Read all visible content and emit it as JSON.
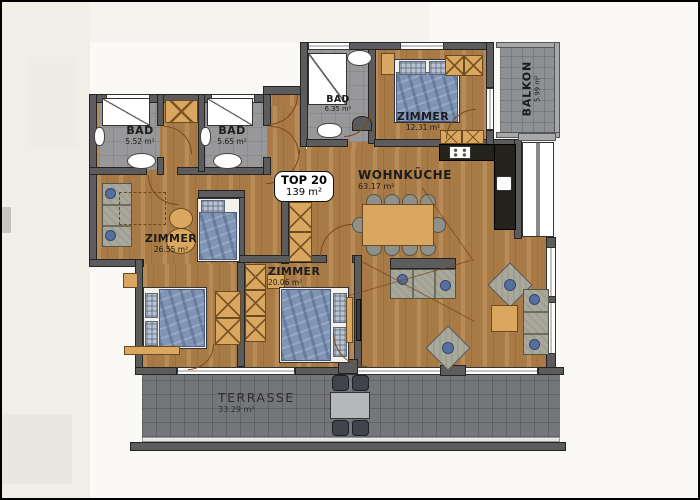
{
  "unit": {
    "name": "TOP 20",
    "area": "139 m²"
  },
  "rooms": {
    "bad1": {
      "name": "BAD",
      "area": "5.52 m²"
    },
    "bad2": {
      "name": "BAD",
      "area": "5.65 m²"
    },
    "bad3": {
      "name": "BAD",
      "area": "6.35 m²"
    },
    "zimmer1": {
      "name": "ZIMMER",
      "area": "12.31 m²"
    },
    "zimmer2": {
      "name": "ZIMMER",
      "area": "26.55 m²"
    },
    "zimmer3": {
      "name": "ZIMMER",
      "area": "20.06 m²"
    },
    "wohnkueche": {
      "name": "WOHNKÜCHE",
      "area": "63.17 m²"
    },
    "balkon": {
      "name": "BALKON",
      "area": "5.99 m²"
    },
    "terrasse": {
      "name": "TERRASSE",
      "area": "33.29 m²"
    }
  },
  "colors": {
    "wall": "#5c5c5c",
    "wood_floor": "#b18049",
    "tile_floor": "#98989a",
    "terrace_floor": "#747679",
    "bed_fabric": "#8095b6",
    "furniture_wood": "#d9a75f",
    "kitchen_counter": "#23231b"
  }
}
